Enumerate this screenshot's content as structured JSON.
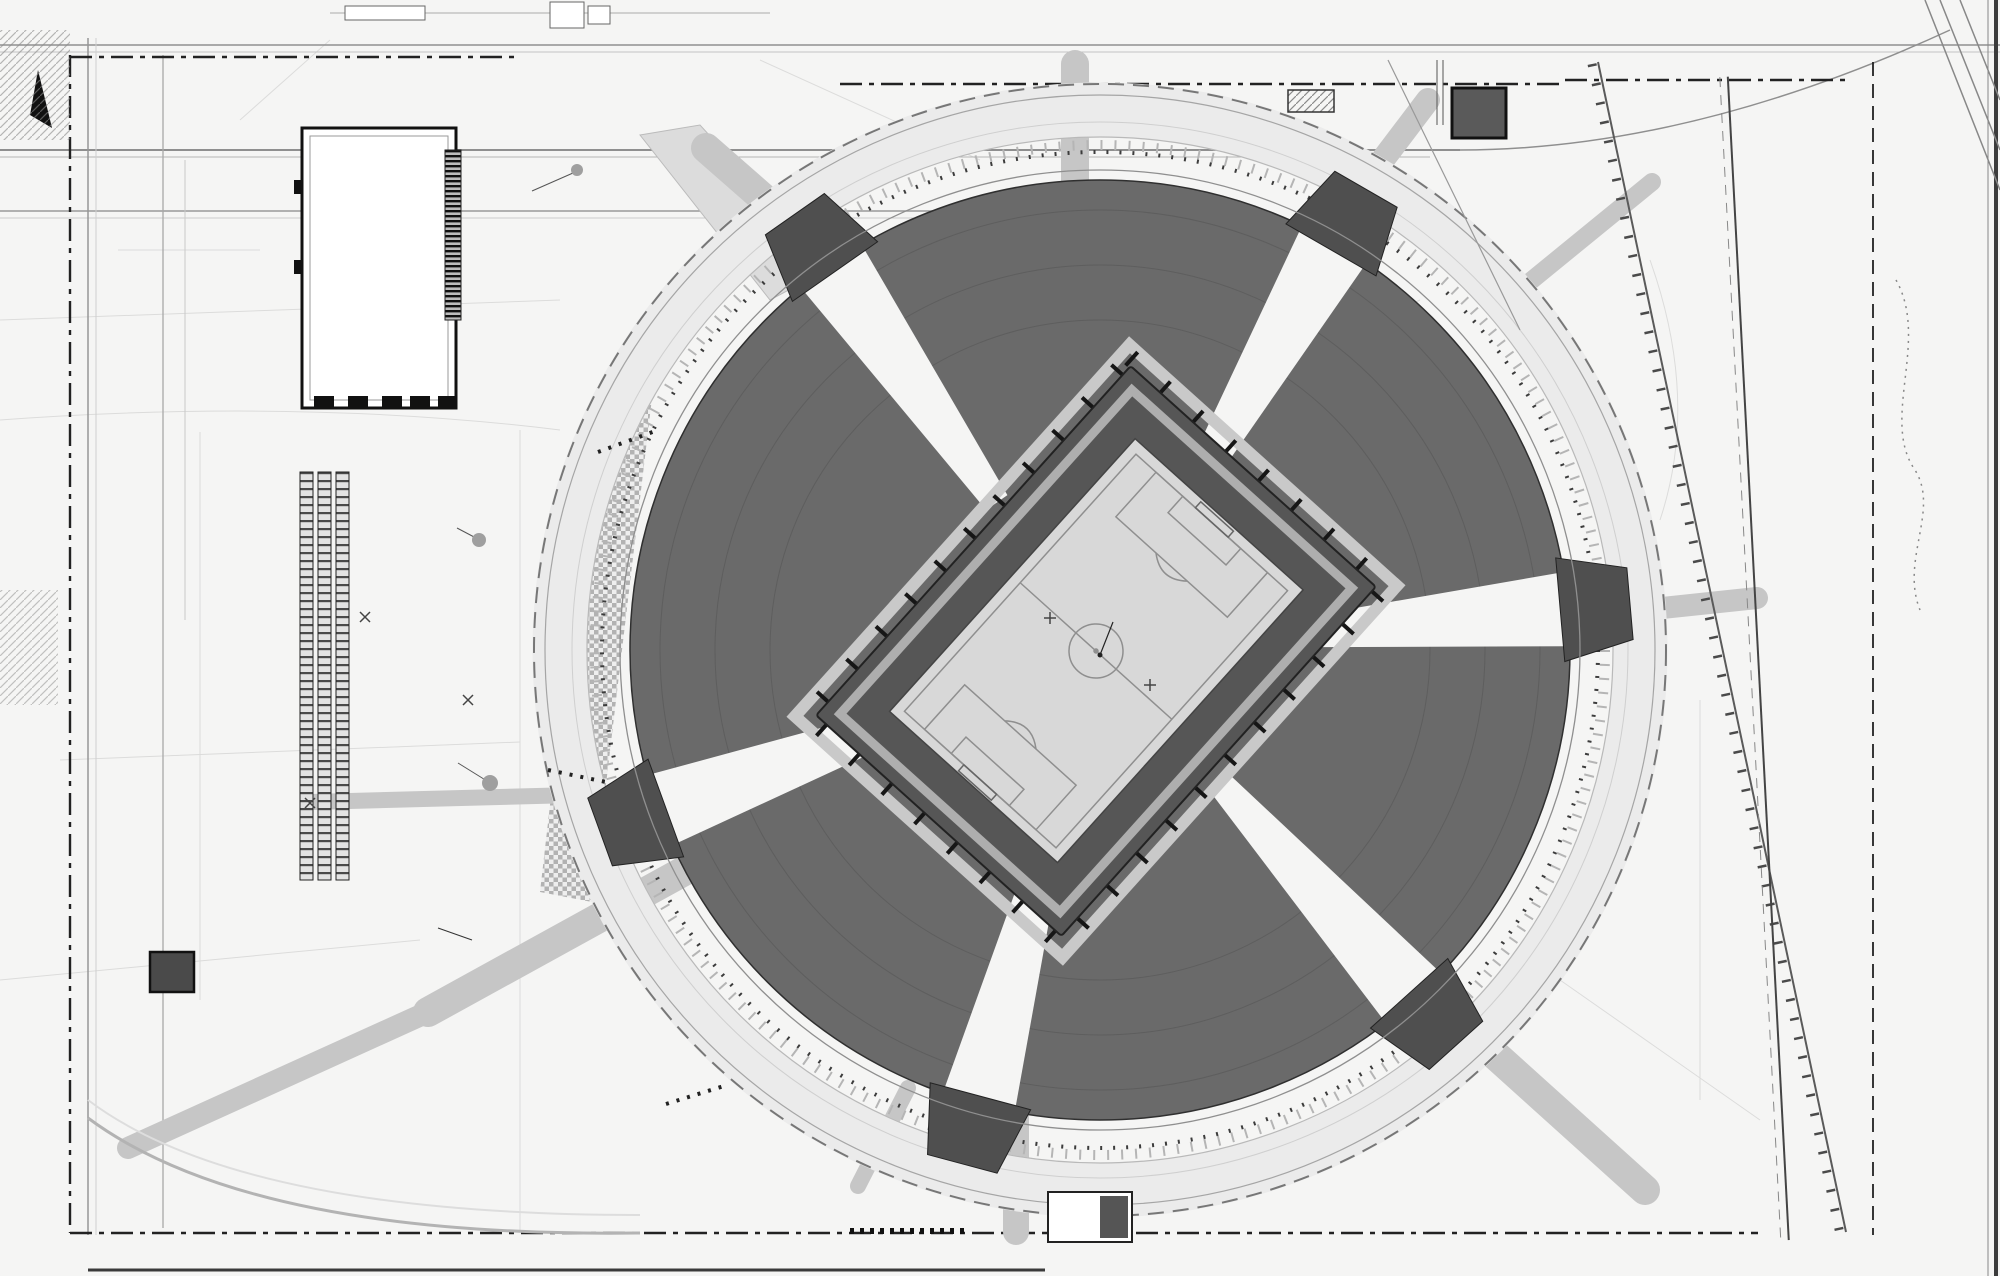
{
  "meta": {
    "drawing_type": "Стройгенплан / план благоустройства стадиона",
    "cutoff_title": "ИТЕЛЬНЫЙ"
  },
  "colors": {
    "paper": "#f5f5f4",
    "stands": "#6a6a6a",
    "apron": "#565656",
    "pitch": "#d8d8d8",
    "pitch_line": "#8f8f8f",
    "tree": "#474747",
    "ink": "#1c1c1c"
  },
  "annotation": {
    "x_label": "X=2732.42",
    "y_label": "Y=2808.31",
    "x": 1113,
    "y": 596
  },
  "labels_boxed": [
    {
      "t": "VLG-IT-1",
      "x": 461,
      "y": 31
    },
    {
      "t": "VLG-S-1",
      "x": 1002,
      "y": 28
    },
    {
      "t": "VLG-P-10",
      "x": 1126,
      "y": 24
    },
    {
      "t": "VLG-P-6",
      "x": 504,
      "y": 196
    },
    {
      "t": "VLG-IT-4",
      "x": 526,
      "y": 331
    },
    {
      "t": "VLG-P-5.2",
      "x": 508,
      "y": 369
    },
    {
      "t": "VLG-IT-5.1",
      "x": 430,
      "y": 525
    },
    {
      "t": "VLG-IT-5.2",
      "x": 429,
      "y": 759
    },
    {
      "t": "VLG-IT-6.2",
      "x": 409,
      "y": 813
    },
    {
      "t": "VLG-P-2.1",
      "x": 490,
      "y": 840
    },
    {
      "t": "VLG-W-2",
      "x": 476,
      "y": 916
    },
    {
      "t": "VLG-IT-2",
      "x": 480,
      "y": 1056
    },
    {
      "t": "VLG-S-2",
      "x": 462,
      "y": 1084
    },
    {
      "t": "VLG-IT-7.1",
      "x": 247,
      "y": 1070
    },
    {
      "t": "VLG-P-3",
      "x": 167,
      "y": 1036
    },
    {
      "t": "VLG-IT-8.1",
      "x": 434,
      "y": 1170
    },
    {
      "t": "VLG-P-4",
      "x": 560,
      "y": 1257
    },
    {
      "t": "VLG-P-7",
      "x": 1655,
      "y": 555
    }
  ],
  "labels_plain": [
    {
      "t": "Миксбордер",
      "x": 396,
      "y": 925,
      "s": 16,
      "c": "#2e2e2e"
    },
    {
      "t": "ПБ-5",
      "x": 1719,
      "y": 147,
      "s": 15,
      "c": "#555555"
    },
    {
      "t": "КН",
      "x": 372,
      "y": 268,
      "s": 9,
      "c": "#777777",
      "rot": -55
    },
    {
      "t": "КН",
      "x": 866,
      "y": 1196,
      "s": 8,
      "c": "#777777"
    },
    {
      "t": "флагштоки",
      "x": 586,
      "y": 448,
      "s": 11,
      "c": "#1c1c1c",
      "u": true
    },
    {
      "t": "флагштоки",
      "x": 557,
      "y": 783,
      "s": 11,
      "c": "#1c1c1c",
      "u": true
    },
    {
      "t": "Флагштоки",
      "x": 655,
      "y": 1115,
      "s": 11,
      "c": "#1c1c1c",
      "u": true
    },
    {
      "t": "ИТЕЛЬНЫЙ",
      "x": 786,
      "y": 1276,
      "s": 15,
      "c": "#333333",
      "b": true
    }
  ],
  "grid_marks": [
    {
      "t": "16",
      "x": 1424,
      "y": 78
    },
    {
      "t": "19",
      "x": 1450,
      "y": 78
    },
    {
      "t": "17",
      "x": 1424,
      "y": 101
    },
    {
      "t": "18",
      "x": 1450,
      "y": 101
    },
    {
      "t": "20",
      "x": 1838,
      "y": 76
    },
    {
      "t": "21",
      "x": 1871,
      "y": 74
    },
    {
      "t": "34",
      "x": 1836,
      "y": 1240
    },
    {
      "t": "33",
      "x": 1938,
      "y": 1240
    },
    {
      "t": "32",
      "x": 1963,
      "y": 1240
    },
    {
      "t": "35",
      "x": 72,
      "y": 1229
    },
    {
      "t": "8",
      "x": 601,
      "y": 393
    }
  ],
  "notes": {
    "top_right": {
      "x": 1356,
      "y": 142,
      "lines": [
        "Объемы работ,",
        "связанные с восст.",
        "после демонтажа",
        "временной инфра-",
        "структуры и газона"
      ]
    },
    "bottom_right": {
      "x": 1090,
      "y": 1181,
      "lines": [
        "после демонтажа",
        "временной инфр.",
        "и газона"
      ]
    }
  },
  "cable_notes": [
    {
      "t": "АСБ 2х240 (ПС \"ТДН\" ф-16 - РП 1200 м)",
      "x": 300,
      "y": 1242
    },
    {
      "t": "2 АСБ 2х240 (ПС \"ТДН\" 2АО - РП 160х12)",
      "x": 300,
      "y": 1251
    },
    {
      "t": "АСБ 2х240 ОК (ПБ 93 ж. ПС УМ-3)",
      "x": 420,
      "y": 1256
    }
  ],
  "micro_texts": [
    {
      "t": "Футляр из труб ПЭ 100",
      "x": 700,
      "y": 468,
      "rot": -25
    },
    {
      "t": "2 кабельные линии 0,4 кВ",
      "x": 400,
      "y": 524,
      "rot": -18
    },
    {
      "t": "Футляр из труб",
      "x": 512,
      "y": 1112,
      "rot": -52
    },
    {
      "t": "Кабельная линия",
      "x": 1000,
      "y": 1128,
      "rot": 28
    }
  ],
  "callouts": [
    {
      "x": 1055,
      "y": 33,
      "n": "43",
      "d": "9",
      "s": [
        1055,
        258
      ]
    },
    {
      "x": 1132,
      "y": 38,
      "n": "45",
      "d": "9",
      "s": [
        1132,
        268
      ]
    },
    {
      "x": 1177,
      "y": 39,
      "n": "44",
      "d": "9",
      "s": [
        1177,
        268
      ]
    },
    {
      "x": 1220,
      "y": 37,
      "n": "45",
      "d": "9",
      "s": [
        1220,
        272
      ]
    },
    {
      "x": 1435,
      "y": 35,
      "n": "19",
      "d": "3",
      "s": [
        1435,
        283
      ]
    },
    {
      "x": 601,
      "y": 33,
      "n": "12",
      "d": "4",
      "s": [
        601,
        225
      ]
    },
    {
      "x": 621,
      "y": 33,
      "n": "11",
      "d": "10",
      "s": [
        621,
        228
      ]
    },
    {
      "x": 660,
      "y": 34,
      "n": "13",
      "d": "2",
      "s": [
        660,
        228
      ]
    },
    {
      "x": 679,
      "y": 34,
      "n": "14",
      "d": "3",
      "s": [
        679,
        230
      ]
    },
    {
      "x": 704,
      "y": 32,
      "n": "15",
      "d": "3",
      "s": [
        704,
        228
      ]
    },
    {
      "x": 719,
      "y": 32,
      "n": "21",
      "d": "5",
      "s": [
        719,
        230
      ]
    },
    {
      "x": 691,
      "y": 97,
      "n": "18"
    },
    {
      "x": 726,
      "y": 95,
      "n": "26"
    },
    {
      "x": 753,
      "y": 101,
      "n": "13"
    },
    {
      "x": 578,
      "y": 195,
      "n": "37",
      "d": "4",
      "s": [
        652,
        215
      ]
    },
    {
      "x": 550,
      "y": 268,
      "n": "4",
      "d": "1",
      "s": [
        612,
        280
      ]
    },
    {
      "x": 578,
      "y": 285,
      "n": "6",
      "d": "2",
      "s": [
        640,
        297
      ]
    },
    {
      "x": 550,
      "y": 321,
      "n": "5",
      "d": "3"
    },
    {
      "x": 580,
      "y": 333,
      "n": "20",
      "d": "4",
      "s": [
        640,
        340
      ]
    },
    {
      "x": 580,
      "y": 350,
      "n": "22",
      "d": "9",
      "s": [
        640,
        358
      ]
    },
    {
      "x": 551,
      "y": 362,
      "n": "11",
      "d": "2"
    },
    {
      "x": 574,
      "y": 374,
      "n": "17",
      "d": "4"
    },
    {
      "x": 510,
      "y": 495,
      "n": "23",
      "d": "4",
      "s": [
        496,
        520
      ]
    },
    {
      "x": 539,
      "y": 627,
      "n": "16"
    },
    {
      "x": 676,
      "y": 506,
      "n": "27"
    },
    {
      "x": 637,
      "y": 786,
      "n": "27"
    },
    {
      "x": 883,
      "y": 175,
      "n": "17",
      "s": [
        900,
        212
      ]
    },
    {
      "x": 1216,
      "y": 284,
      "n": "16",
      "s": [
        1200,
        310
      ]
    },
    {
      "x": 1388,
      "y": 339,
      "n": "17",
      "s": [
        1370,
        360
      ]
    },
    {
      "x": 1532,
      "y": 409,
      "n": "15",
      "s": [
        1510,
        430
      ]
    },
    {
      "x": 1562,
      "y": 489,
      "n": "14",
      "s": [
        1540,
        505
      ]
    },
    {
      "x": 1655,
      "y": 519,
      "n": "25"
    },
    {
      "x": 1556,
      "y": 735,
      "n": "15",
      "s": [
        1535,
        720
      ]
    },
    {
      "x": 1544,
      "y": 898,
      "n": "16",
      "s": [
        1522,
        880
      ]
    },
    {
      "x": 1518,
      "y": 946,
      "n": "23",
      "s": [
        1498,
        930
      ]
    },
    {
      "x": 1455,
      "y": 1032,
      "n": "12",
      "s": [
        1437,
        1015
      ]
    },
    {
      "x": 1242,
      "y": 1112,
      "n": "14",
      "s": [
        1252,
        1090
      ]
    },
    {
      "x": 708,
      "y": 352,
      "n": "12",
      "s": [
        728,
        372
      ]
    },
    {
      "x": 91,
      "y": 658,
      "n": "13"
    },
    {
      "x": 1284,
      "y": 123,
      "n": "19",
      "s": [
        1264,
        150
      ]
    },
    {
      "x": 1305,
      "y": 123,
      "n": "26"
    },
    {
      "x": 1338,
      "y": 140,
      "n": "14"
    },
    {
      "x": 1478,
      "y": 113,
      "n": "6"
    },
    {
      "x": 1327,
      "y": 177,
      "n": "29",
      "d": "9"
    },
    {
      "x": 1280,
      "y": 187,
      "n": "45",
      "d": "50"
    },
    {
      "x": 1484,
      "y": 175,
      "n": "38",
      "d": "15",
      "s": [
        1450,
        180
      ]
    },
    {
      "x": 1435,
      "y": 175,
      "n": "33",
      "d": "6"
    },
    {
      "x": 1423,
      "y": 202,
      "n": "3",
      "d": "1",
      "s": [
        1423,
        240
      ]
    },
    {
      "x": 1479,
      "y": 207,
      "n": "9",
      "d": "1",
      "s": [
        1479,
        245
      ]
    },
    {
      "x": 1273,
      "y": 232,
      "n": "30",
      "d": "1"
    },
    {
      "x": 1572,
      "y": 230,
      "n": "48",
      "d": "12",
      "s": [
        1540,
        240
      ]
    },
    {
      "x": 1686,
      "y": 138,
      "n": "13"
    },
    {
      "x": 1708,
      "y": 1160,
      "n": "13"
    },
    {
      "x": 91,
      "y": 962,
      "n": "13"
    },
    {
      "x": 160,
      "y": 970,
      "n": "3"
    },
    {
      "x": 108,
      "y": 1180,
      "n": "32",
      "d": "14",
      "s": [
        150,
        1190
      ]
    },
    {
      "x": 403,
      "y": 1067,
      "n": "25",
      "s": [
        380,
        1040
      ]
    },
    {
      "x": 557,
      "y": 915,
      "n": "43",
      "d": "15",
      "s": [
        610,
        915
      ]
    },
    {
      "x": 621,
      "y": 934,
      "n": "15",
      "d": "3",
      "s": [
        660,
        934
      ]
    },
    {
      "x": 640,
      "y": 985,
      "n": "14",
      "d": "2",
      "s": [
        680,
        990
      ]
    },
    {
      "x": 662,
      "y": 1019,
      "n": "16"
    },
    {
      "x": 675,
      "y": 1030,
      "n": "13",
      "d": "5",
      "s": [
        700,
        1035
      ]
    },
    {
      "x": 565,
      "y": 1015,
      "n": "12",
      "d": "3",
      "s": [
        600,
        1015
      ]
    },
    {
      "x": 704,
      "y": 1047,
      "n": "15",
      "d": "6",
      "s": [
        730,
        1052
      ]
    },
    {
      "x": 500,
      "y": 1074,
      "n": "8",
      "d": "3"
    },
    {
      "x": 500,
      "y": 1120,
      "n": "5",
      "d": "3"
    },
    {
      "x": 485,
      "y": 1135,
      "n": "4",
      "d": "3"
    },
    {
      "x": 495,
      "y": 1167,
      "n": "12",
      "d": "9"
    },
    {
      "x": 485,
      "y": 1182,
      "n": "34",
      "d": "10"
    },
    {
      "x": 310,
      "y": 1261,
      "n": "17",
      "d": "3",
      "s": [
        310,
        1230
      ]
    },
    {
      "x": 347,
      "y": 1261,
      "n": "16",
      "d": "3",
      "s": [
        347,
        1230
      ]
    },
    {
      "x": 388,
      "y": 1260,
      "n": "13",
      "d": "3",
      "s": [
        388,
        1230
      ]
    },
    {
      "x": 428,
      "y": 1258,
      "n": "15",
      "d": "5",
      "s": [
        428,
        1228
      ]
    },
    {
      "x": 470,
      "y": 1258,
      "n": "11",
      "d": "3",
      "s": [
        470,
        1228
      ]
    },
    {
      "x": 508,
      "y": 1258,
      "n": "31",
      "d": "18",
      "s": [
        508,
        1228
      ]
    },
    {
      "x": 569,
      "y": 1260,
      "n": "46",
      "d": "9",
      "s": [
        569,
        1230
      ]
    },
    {
      "x": 760,
      "y": 1258,
      "n": "47",
      "d": "10",
      "s": [
        760,
        1230
      ]
    },
    {
      "x": 1148,
      "y": 1245,
      "n": "41",
      "d": "9",
      "s": [
        1148,
        1215
      ]
    },
    {
      "x": 1230,
      "y": 1248,
      "n": "9",
      "d": "5",
      "s": [
        1230,
        1218
      ]
    },
    {
      "x": 1333,
      "y": 1250,
      "n": "14",
      "d": "5",
      "s": [
        1333,
        1220
      ]
    },
    {
      "x": 1443,
      "y": 1252,
      "n": "33",
      "d": "10",
      "s": [
        1443,
        1222
      ]
    },
    {
      "x": 1490,
      "y": 1252,
      "n": "48",
      "d": "12",
      "s": [
        1490,
        1222
      ]
    },
    {
      "x": 1068,
      "y": 1200,
      "n": "19"
    },
    {
      "x": 1086,
      "y": 1222,
      "n": "18"
    },
    {
      "x": 1028,
      "y": 633,
      "n": "1"
    }
  ]
}
